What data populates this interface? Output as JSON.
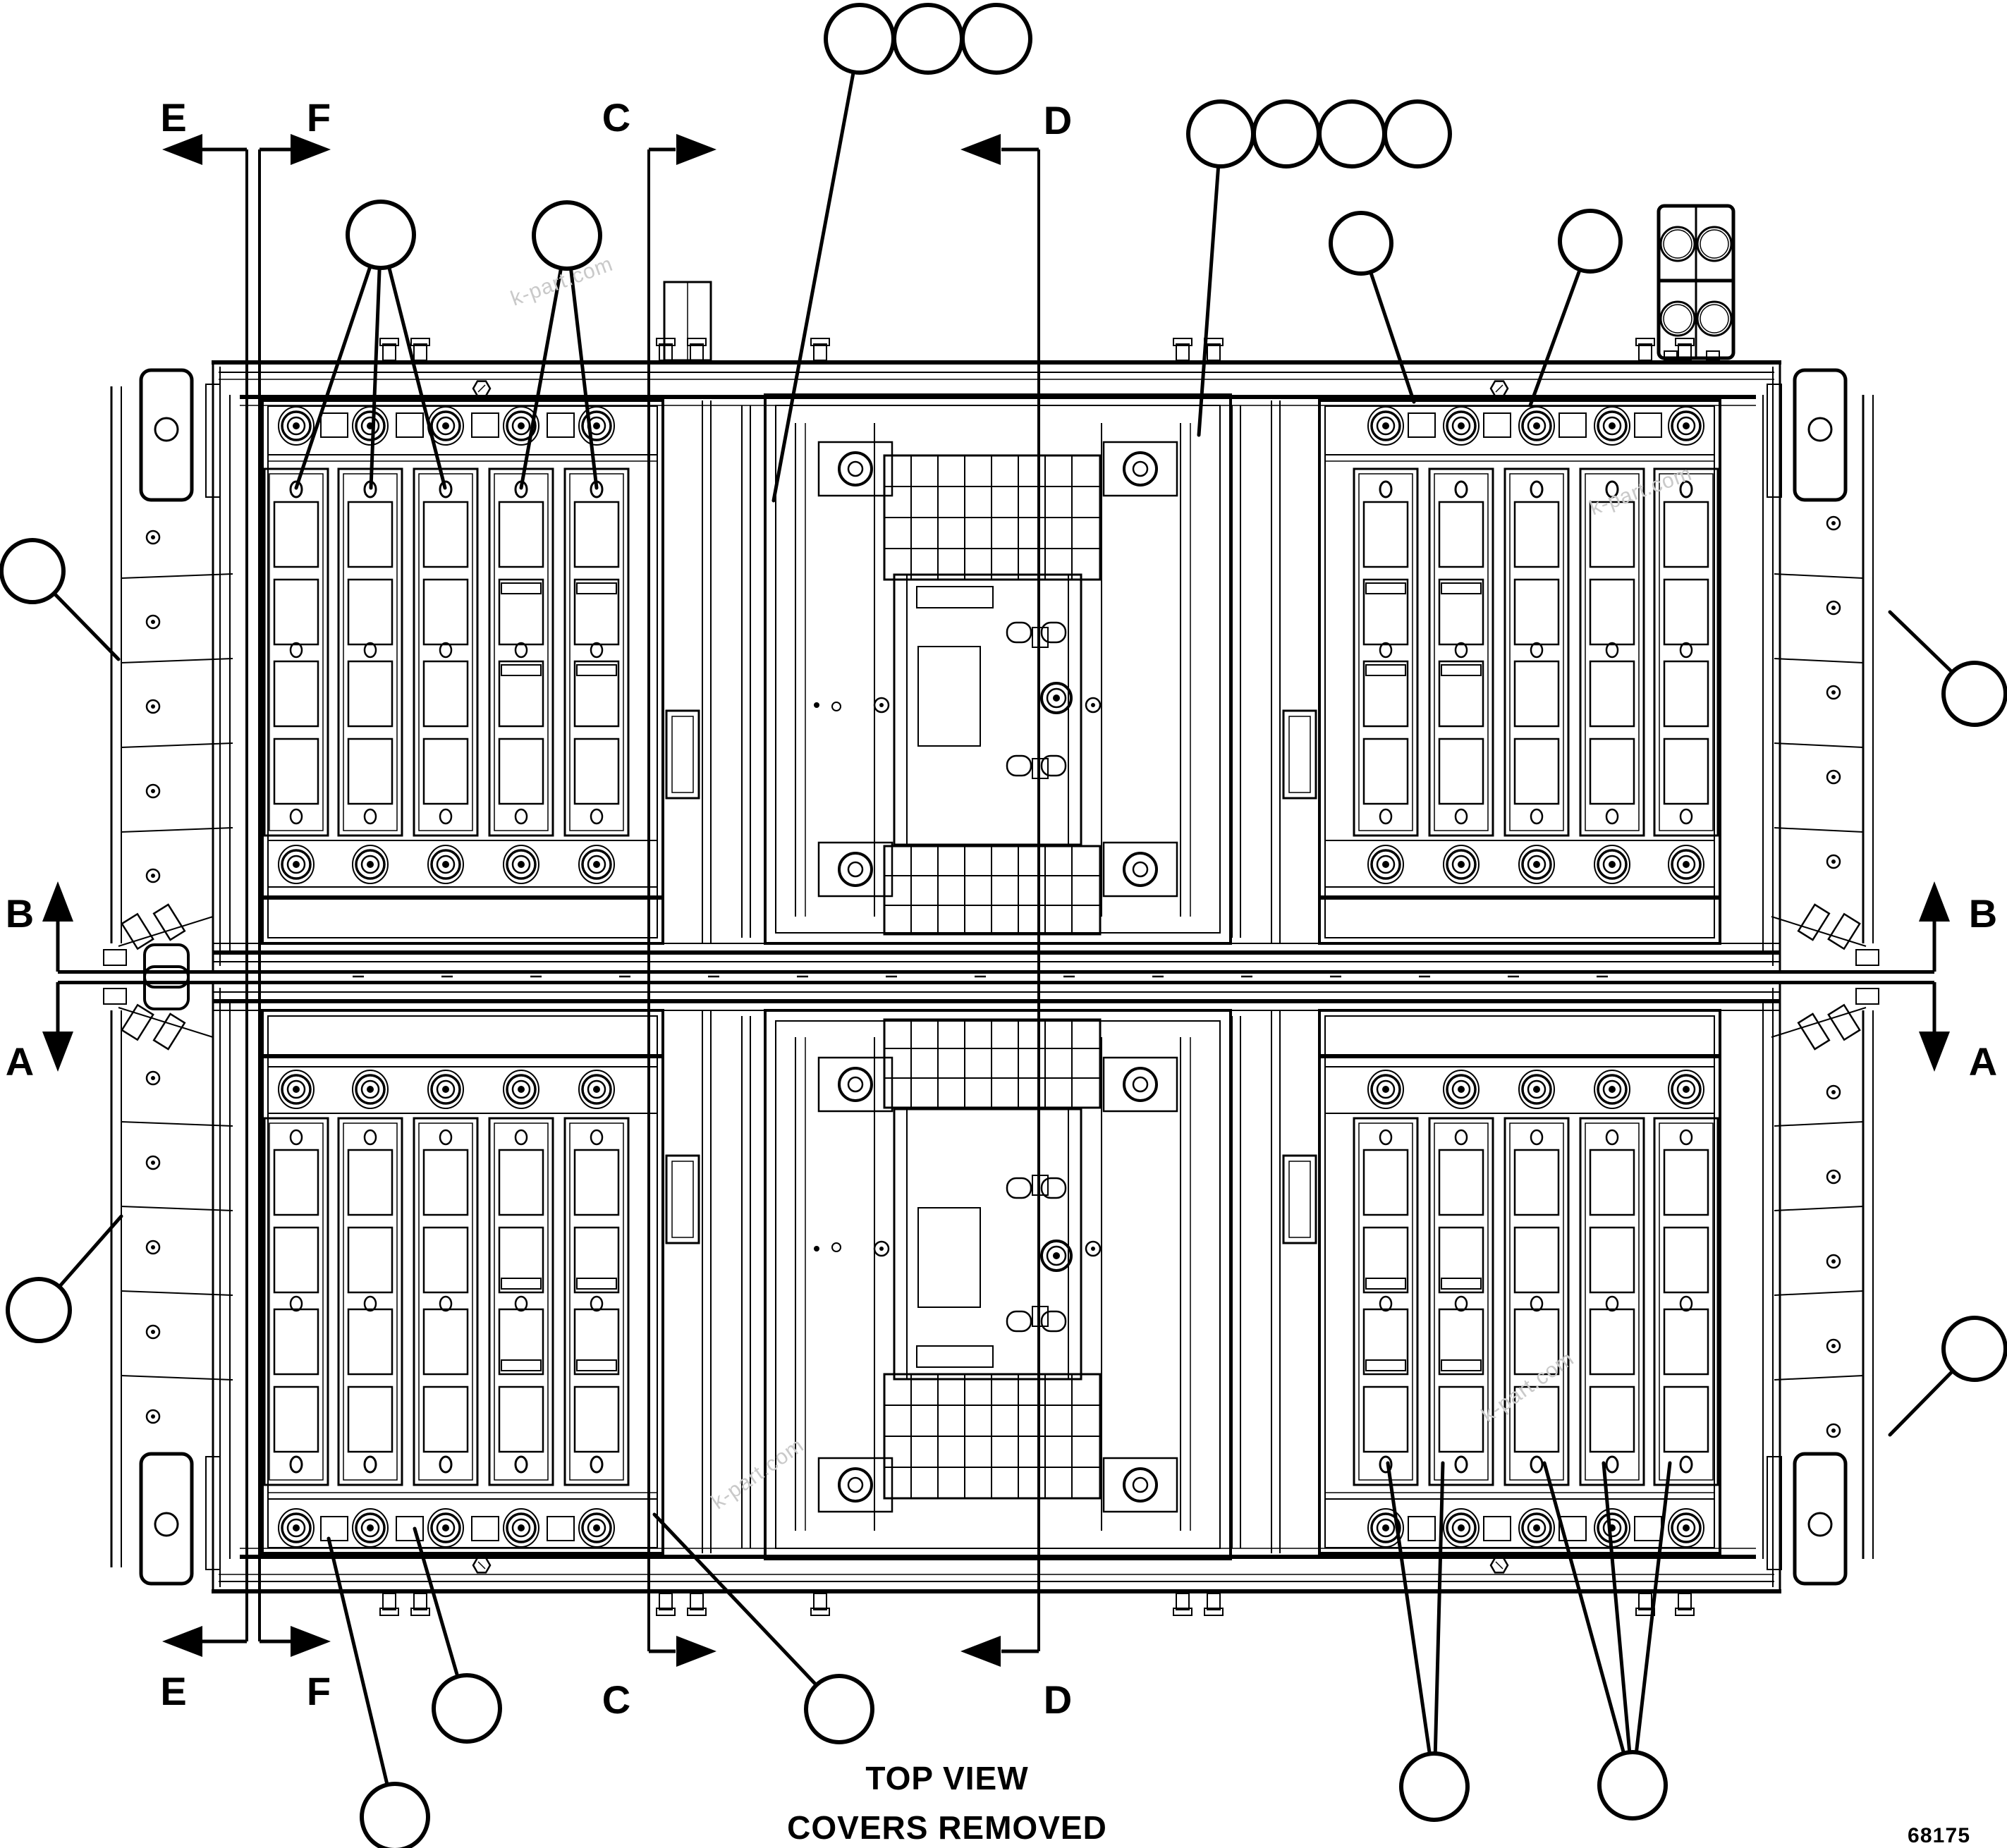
{
  "page": {
    "background": "#ffffff",
    "ink": "#000000",
    "watermark_color": "#c9c9c9"
  },
  "title_block": {
    "view_title": "TOP VIEW",
    "view_subtitle": "COVERS REMOVED",
    "drawing_number": "68175"
  },
  "section_markers": {
    "e": {
      "label": "E",
      "direction": "left"
    },
    "f": {
      "label": "F",
      "direction": "right"
    },
    "c": {
      "label": "C",
      "direction": "right"
    },
    "d": {
      "label": "D",
      "direction": "left"
    },
    "b": {
      "label": "B",
      "direction": "up"
    },
    "a": {
      "label": "A",
      "direction": "down"
    }
  },
  "watermark": {
    "text": "k-part.com",
    "count": 4
  },
  "callouts": {
    "style": "empty-balloon",
    "count": 20
  },
  "drawing": {
    "kind": "parts-diagram-top-view",
    "halves": 2,
    "battery_slats_per_panel": 5
  }
}
